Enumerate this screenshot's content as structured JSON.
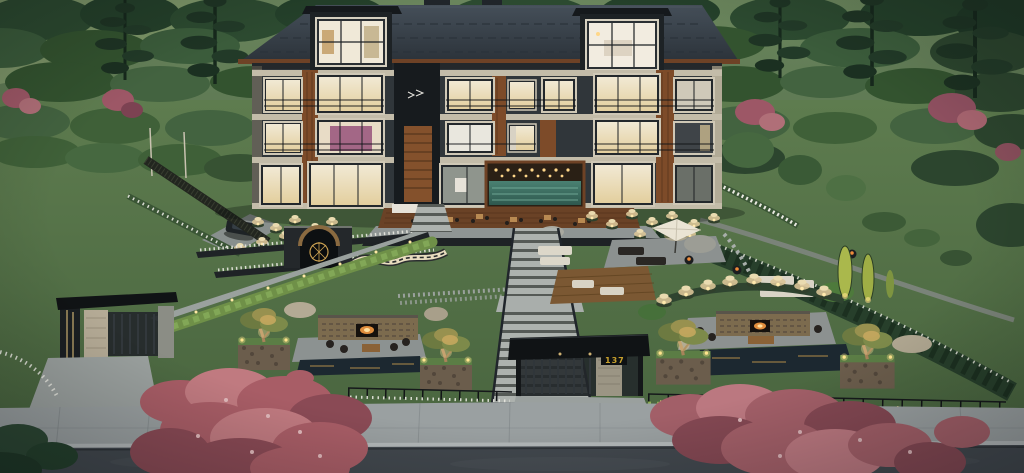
{
  "scene": {
    "type": "3D architectural exterior rendering",
    "time_of_day": "dusk",
    "description": "Four-story timber-and-charcoal apartment building with glowing windows and two large roof dormers on a terraced, landscaped hillside; a central garden staircase descends to a street-front gate canopy flanked by fire-pit lounges, reflecting pools, illuminated planter trees and pampas grass; forested hills behind, red maples in the foreground along sidewalk and road"
  },
  "gate": {
    "house_number": "137"
  },
  "palette": {
    "forest_dark": "#24402a",
    "forest_mid": "#3b5c3b",
    "hill_light": "#7e9769",
    "lawn": "#5e7c4f",
    "lawn_shade": "#49653f",
    "maple_red": "#a85d66",
    "maple_red_light": "#c07a80",
    "facade_charcoal": "#30363a",
    "roof_slate": "#39434c",
    "wood_accent": "#7d4b29",
    "stone_trim": "#c3bca9",
    "window_warm": "#f2e4c2",
    "window_glow": "#ffd789",
    "interior_magenta": "#97527a",
    "pool_teal": "#3f7265",
    "hardscape": "#9aa19e",
    "wall_dark": "#1f2326",
    "deck_wood": "#6a4226",
    "pampas_cream": "#d9c497",
    "uplight": "#ffe48d",
    "fire_orange": "#f08c3a",
    "water_dark": "#1c2830",
    "sidewalk": "#9aa0a1",
    "road_asphalt": "#42484e",
    "gate_black": "#101315",
    "sign_gold": "#c8a12d",
    "flower_white": "#e9e9e1"
  }
}
